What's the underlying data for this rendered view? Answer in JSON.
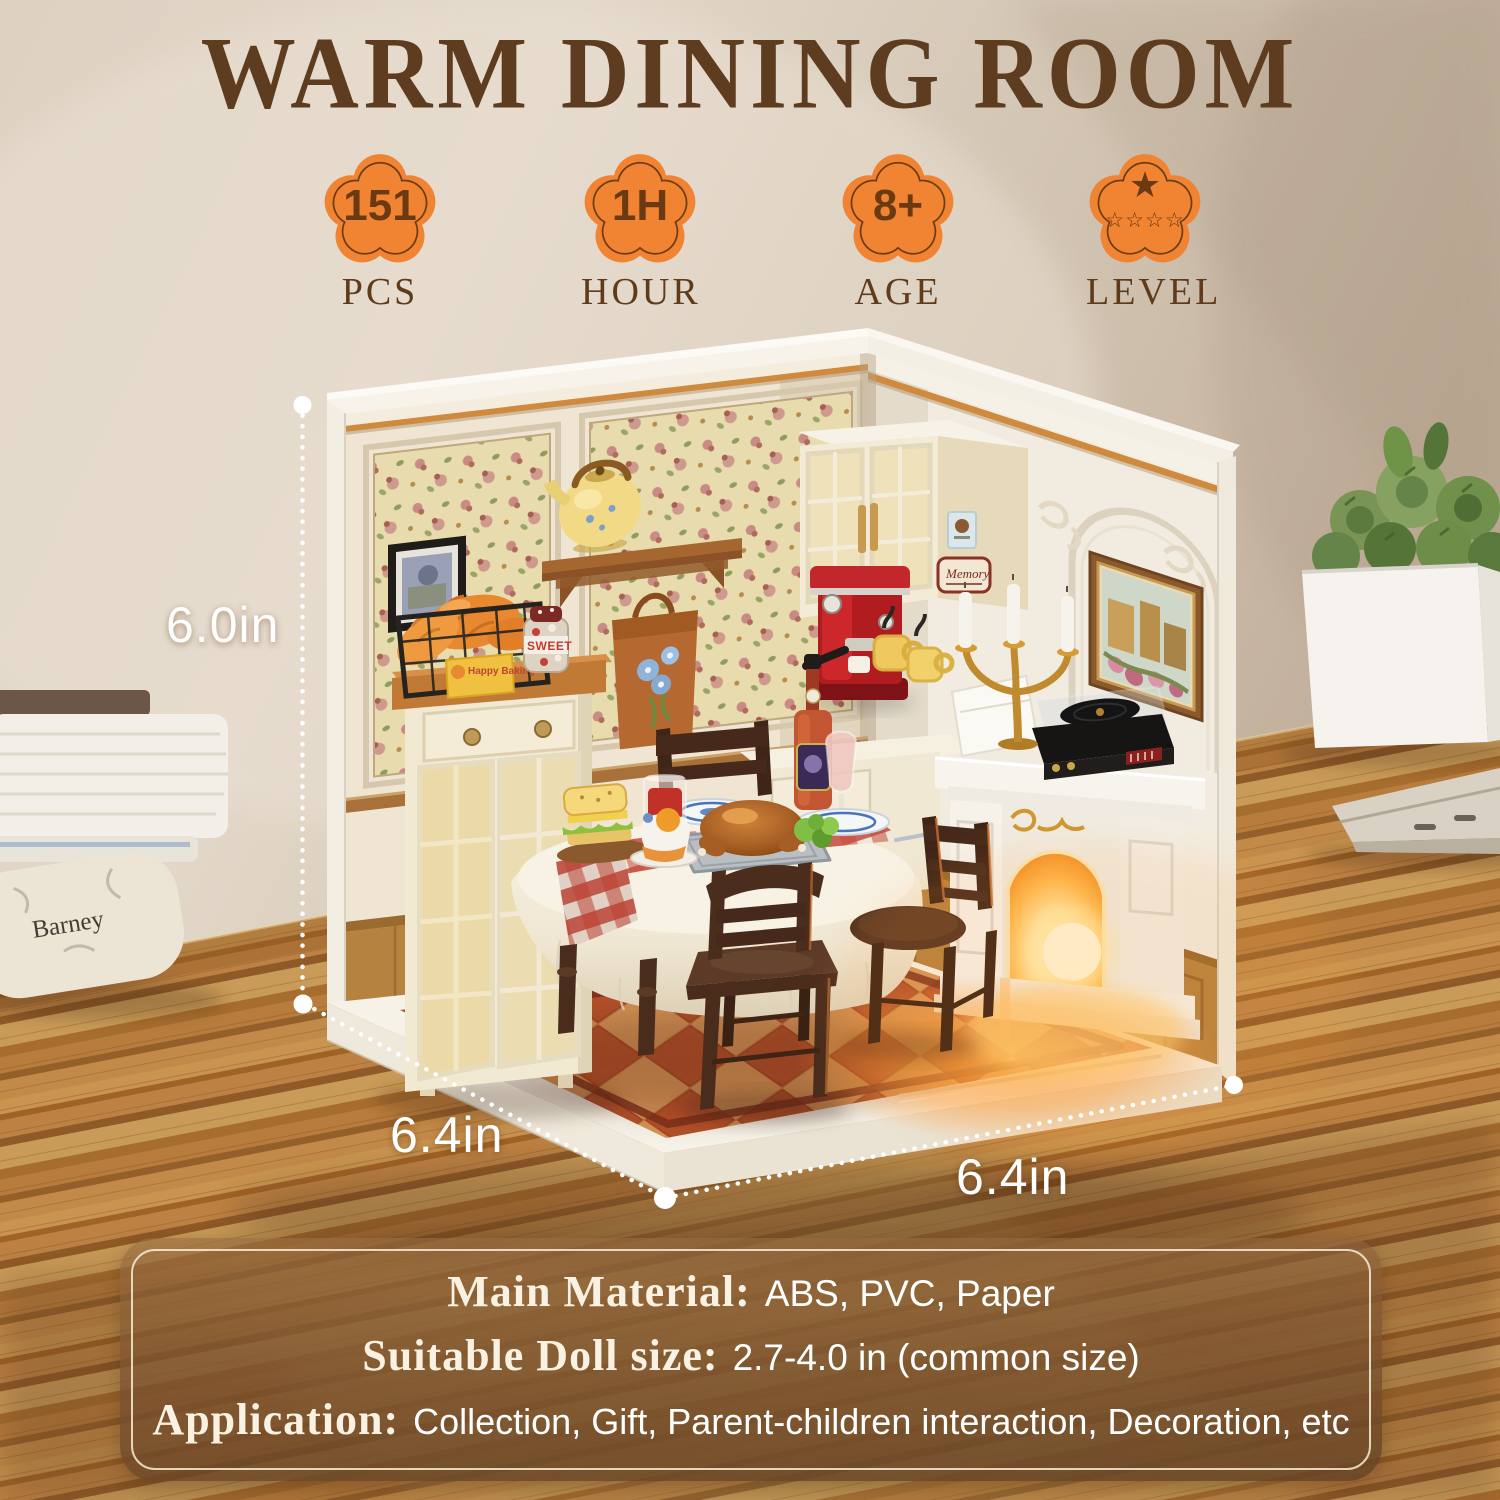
{
  "title": "WARM DINING ROOM",
  "badges": [
    {
      "value": "151",
      "label": "PCS"
    },
    {
      "value": "1H",
      "label": "HOUR"
    },
    {
      "value": "8+",
      "label": "AGE"
    },
    {
      "value": "",
      "label": "LEVEL",
      "stars_top": "★",
      "stars_bottom": "☆☆☆☆"
    }
  ],
  "dimensions": {
    "height": "6.0in",
    "depth": "6.4in",
    "width": "6.4in"
  },
  "specs": [
    {
      "label": "Main Material:",
      "value": "ABS, PVC, Paper"
    },
    {
      "label": "Suitable Doll size:",
      "value": "2.7-4.0 in (common size)"
    },
    {
      "label": "Application:",
      "value": "Collection, Gift, Parent-children interaction, Decoration, etc"
    }
  ],
  "scene": {
    "book_spine": "Barney",
    "jar_label": "SWEET",
    "basket_tag": "Happy Baking",
    "wall_sign": "Memory"
  },
  "colors": {
    "badge_orange": "#f08432",
    "badge_text": "#6b3a12",
    "title_brown": "#5e3c1f",
    "label_brown": "#5f3b1c",
    "annotation_white": "#ffffff",
    "panel_overlay": "#7a5230",
    "panel_border": "#f7edd8",
    "wood_desk": "#b97f41",
    "floor_tile_red": "#b14f2c",
    "floor_tile_tan": "#d9a061",
    "fire_glow": "#ffb94e"
  }
}
